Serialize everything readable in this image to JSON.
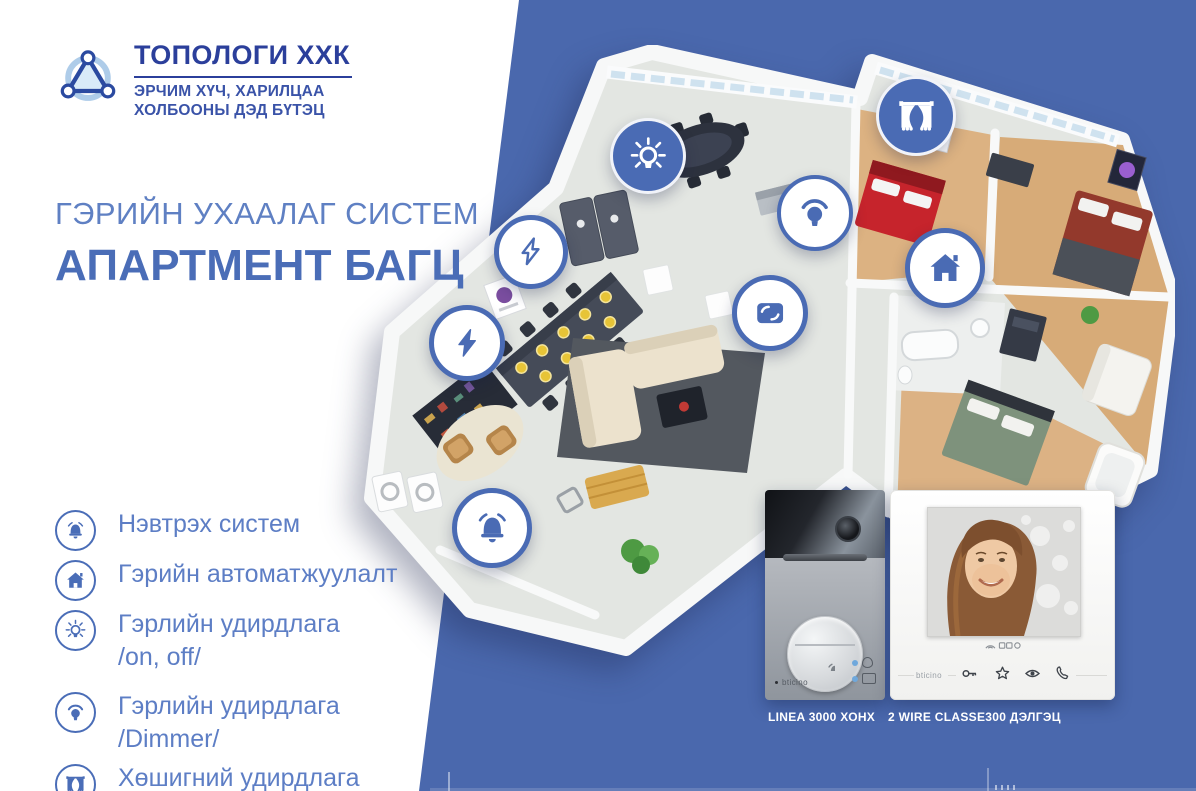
{
  "brand": {
    "name": "ТОПОЛОГИ ХХК",
    "tagline1": "ЭРЧИМ ХҮЧ, ХАРИЛЦАА",
    "tagline2": "ХОЛБООНЫ ДЭД БҮТЭЦ",
    "logo_icon": "network-triangle-icon"
  },
  "hero": {
    "kicker": "ГЭРИЙН УХААЛАГ СИСТЕМ",
    "title": "АПАРТМЕНТ БАГЦ"
  },
  "features": [
    {
      "icon": "doorbell-icon",
      "lines": [
        "Нэвтрэх систем"
      ]
    },
    {
      "icon": "home-icon",
      "lines": [
        "Гэрийн автоматжуулалт"
      ]
    },
    {
      "icon": "light-on-off-icon",
      "lines": [
        "Гэрлийн удирдлага",
        "/on, off/"
      ]
    },
    {
      "icon": "light-dimmer-icon",
      "lines": [
        "Гэрлийн удирдлага",
        "/Dimmer/"
      ]
    },
    {
      "icon": "curtain-icon",
      "lines": [
        "Хөшигний удирдлага"
      ]
    }
  ],
  "floorplan": {
    "description": "isometric 3D apartment floor plan",
    "markers": [
      "light-on-off-icon",
      "curtain-icon",
      "light-dimmer-icon",
      "power-icon",
      "home-icon",
      "scene-screen-icon",
      "power-icon",
      "doorbell-icon"
    ]
  },
  "products": [
    {
      "caption": "LINEA 3000 ХОНХ",
      "brand_label": "bticino"
    },
    {
      "caption": "2 WIRE CLASSE300 ДЭЛГЭЦ",
      "brand_label": "bticino"
    }
  ],
  "colors": {
    "background_blue": "#4a68ad",
    "marker_blue": "#4a6bb4",
    "accent_blue": "#4a6db7",
    "dark_blue": "#2b3f9b",
    "text_blue": "#5d7ec5"
  }
}
